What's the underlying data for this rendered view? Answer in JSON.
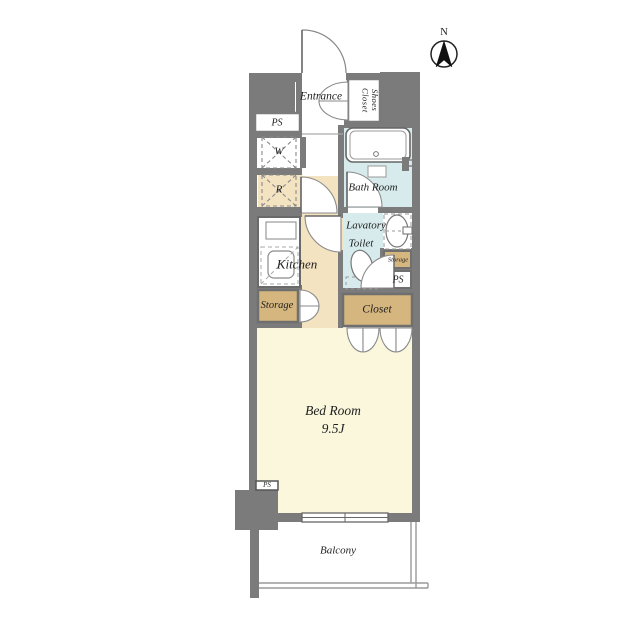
{
  "title": "Apartment floor plan",
  "compass": {
    "label": "N",
    "icon": "north-compass-icon"
  },
  "rooms": {
    "entrance": {
      "label": "Entrance"
    },
    "shoes_closet": {
      "label": "Shoes Closet"
    },
    "ps_top": {
      "label": "PS"
    },
    "washer": {
      "label": "W"
    },
    "fridge": {
      "label": "R"
    },
    "bathroom": {
      "label": "Bath Room"
    },
    "lavatory": {
      "label_line1": "Lavatory",
      "label_line2": "Toilet"
    },
    "storage_small": {
      "label": "Storage"
    },
    "ps_mid": {
      "label": "PS"
    },
    "kitchen": {
      "label": "Kitchen"
    },
    "storage_left": {
      "label": "Storage"
    },
    "closet": {
      "label": "Closet"
    },
    "bedroom": {
      "label": "Bed Room",
      "size": "9.5J"
    },
    "ps_bottom": {
      "label": "PS"
    },
    "balcony": {
      "label": "Balcony"
    }
  },
  "colors": {
    "wall": "#7b7b7b",
    "kitchen_floor": "#f4e3c1",
    "bedroom_floor": "#faf7dd",
    "wet_area_floor": "#d7eaec",
    "closet_fill": "#d6b67f",
    "fixture_line": "#808080",
    "text": "#1f1f1f"
  }
}
